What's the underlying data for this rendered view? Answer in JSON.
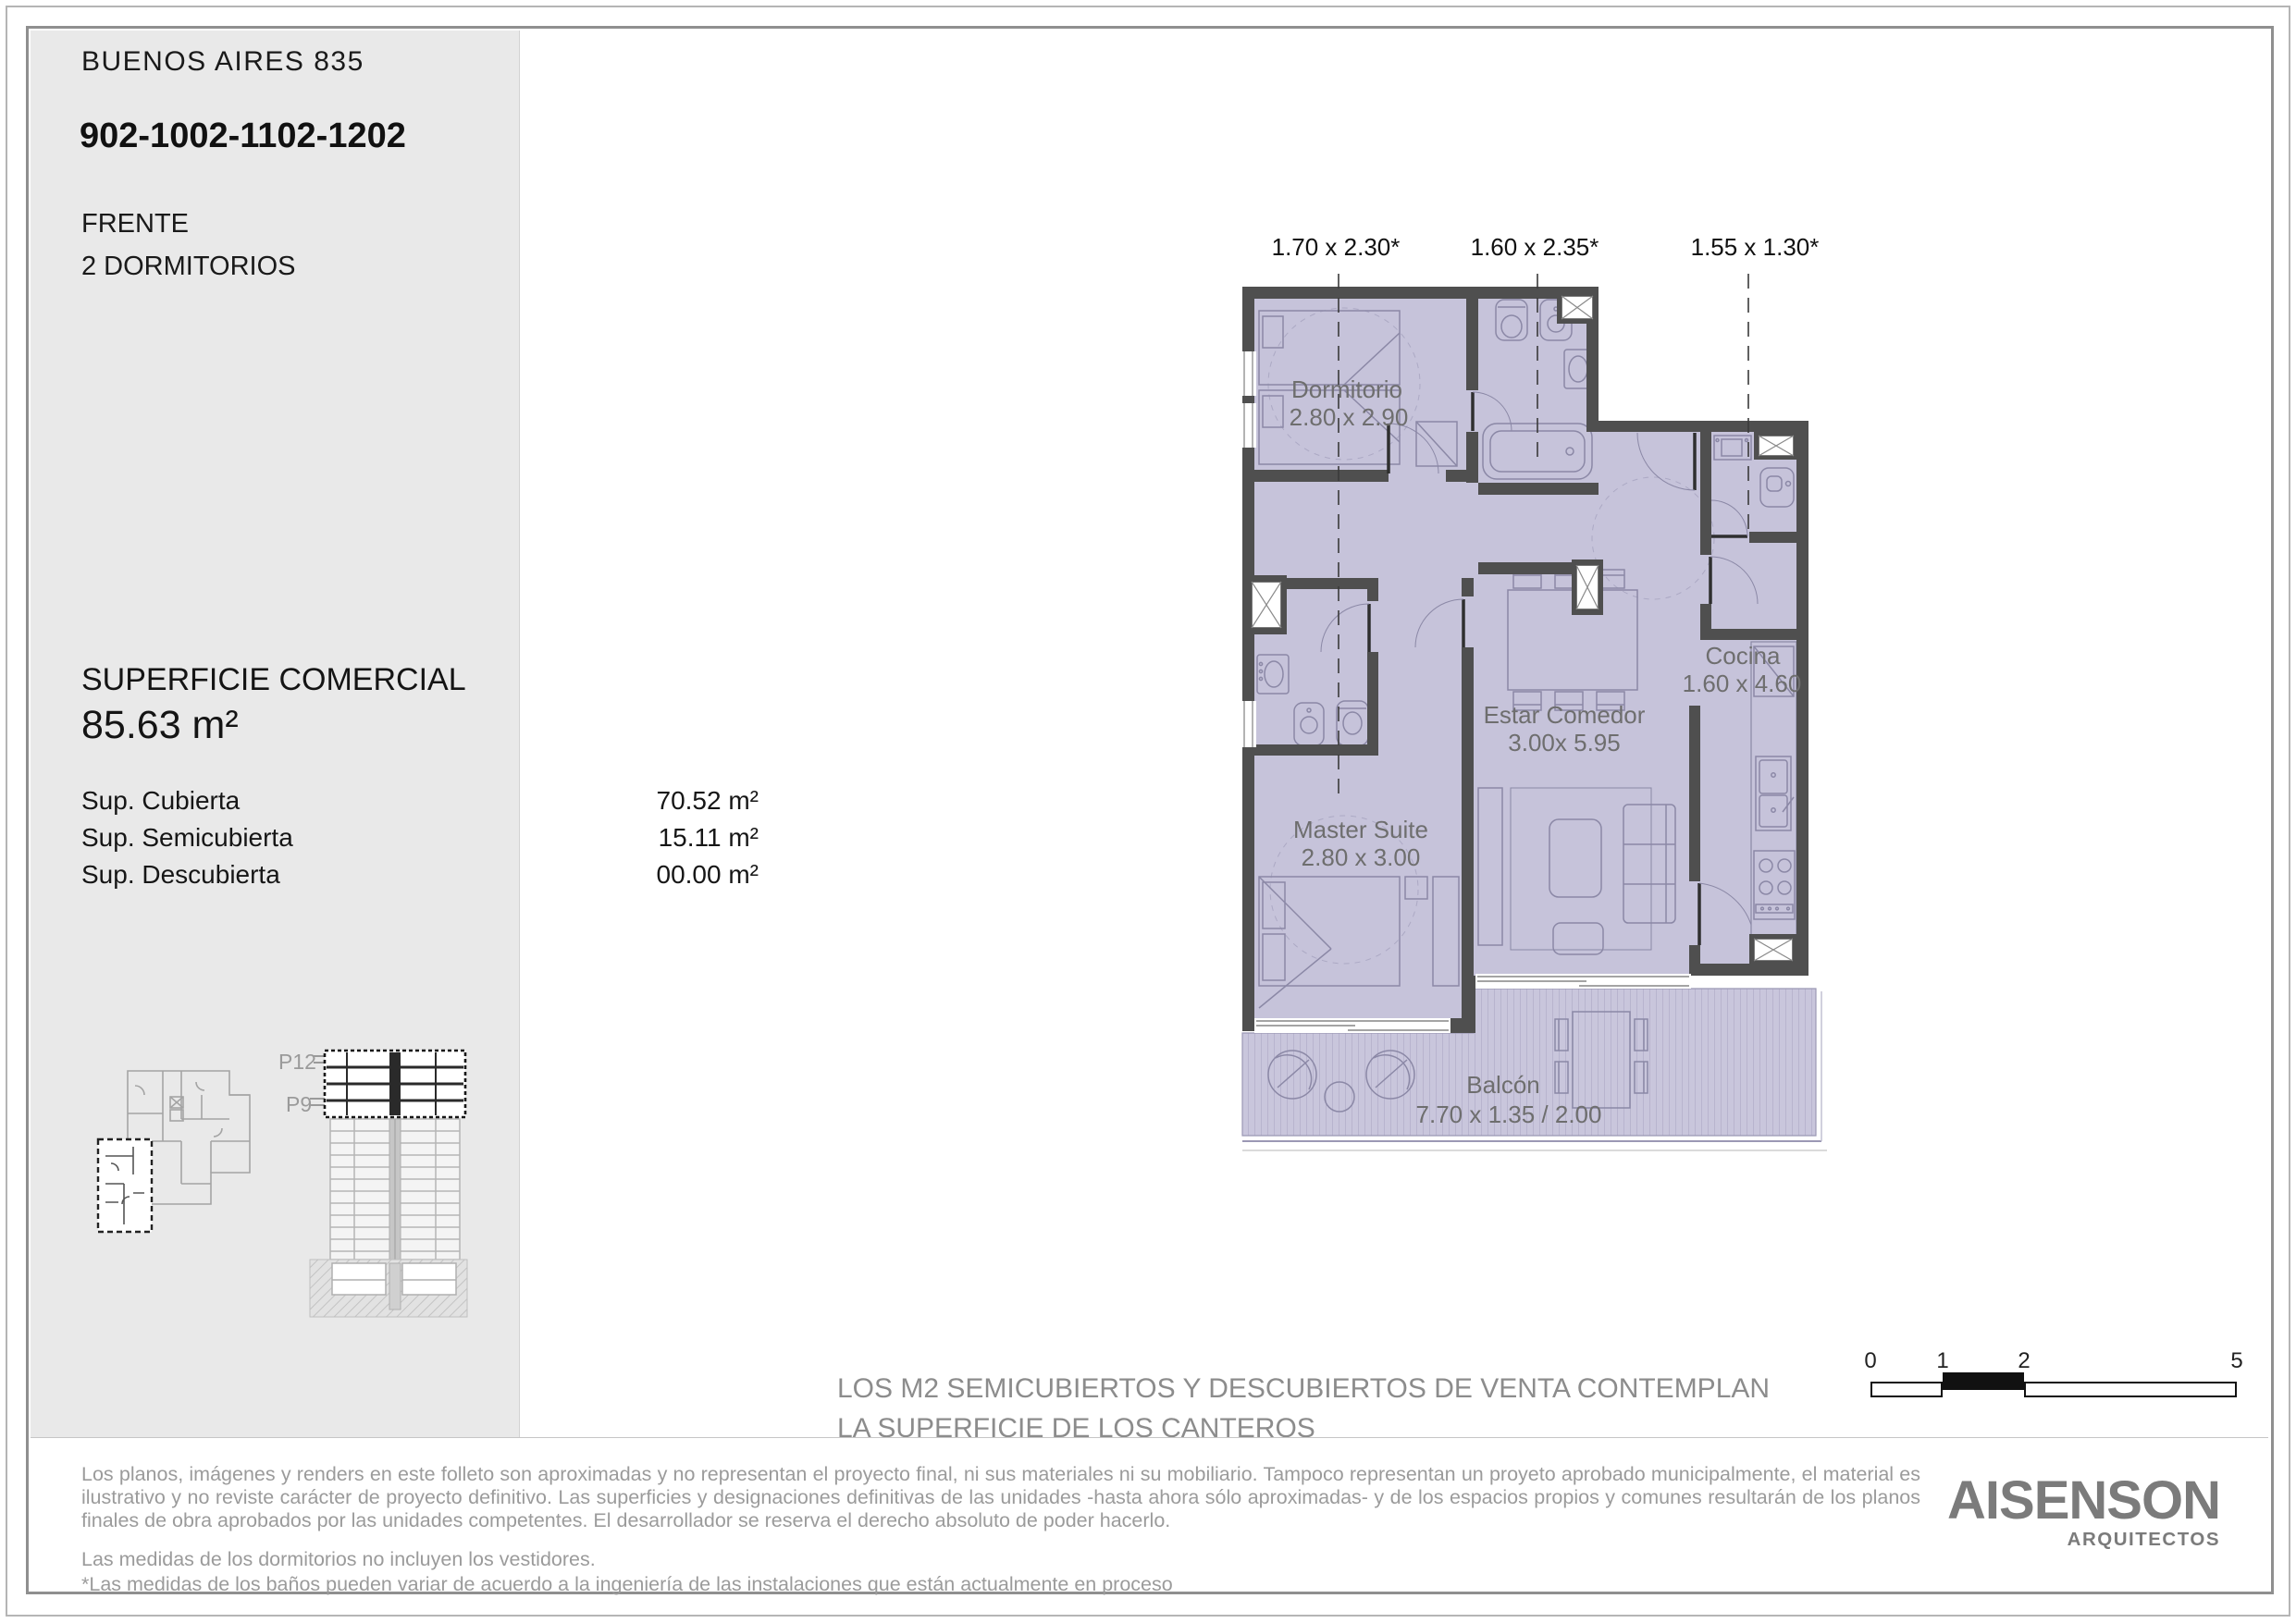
{
  "page": {
    "header": {
      "project": "BUENOS AIRES 835",
      "units": "902-1002-1102-1202",
      "orientation": "FRENTE",
      "typology": "2 DORMITORIOS"
    },
    "surface": {
      "title": "SUPERFICIE COMERCIAL",
      "total": "85.63 m²",
      "rows": [
        {
          "label": "Sup. Cubierta",
          "value": "70.52 m²"
        },
        {
          "label": "Sup. Semicubierta",
          "value": "15.11 m²"
        },
        {
          "label": "Sup. Descubierta",
          "value": "00.00 m²"
        }
      ]
    },
    "section_labels": {
      "p12": "P12",
      "p9": "P9"
    },
    "plan": {
      "dim_labels": [
        "1.70 x 2.30*",
        "1.60 x 2.35*",
        "1.55 x 1.30*"
      ],
      "rooms": {
        "dormitorio": {
          "name": "Dormitorio",
          "size": "2.80 x 2.90"
        },
        "estar": {
          "name": "Estar Comedor",
          "size": "3.00x 5.95"
        },
        "cocina": {
          "name": "Cocina",
          "size": "1.60 x 4.60"
        },
        "master": {
          "name": "Master Suite",
          "size": "2.80 x 3.00"
        },
        "balcon": {
          "name": "Balcón",
          "size": "7.70 x 1.35 / 2.00"
        }
      }
    },
    "scale_bar": {
      "t0": "0",
      "t1": "1",
      "t2": "2",
      "t5": "5"
    },
    "note": {
      "line1": "LOS M2 SEMICUBIERTOS Y DESCUBIERTOS DE VENTA CONTEMPLAN",
      "line2": "LA SUPERFICIE DE LOS CANTEROS"
    },
    "disclaimer": {
      "p1": "Los planos, imágenes y renders en este folleto son aproximadas y no representan el proyecto final, ni sus materiales ni su mobiliario. Tampoco representan un proyeto aprobado municipalmente, el material es ilustrativo y no reviste carácter de proyecto definitivo. Las superficies y designaciones definitivas de las unidades -hasta ahora sólo aproximadas- y de los espacios propios y comunes resultarán de los planos finales de obra aprobados por las unidades competentes. El desarrollador se reserva el derecho absoluto de poder hacerlo.",
      "p2": "Las medidas de los dormitorios no incluyen los vestidores.",
      "p3": "*Las medidas de los baños pueden variar de acuerdo a la ingeniería de las instalaciones que están actualmente en proceso"
    },
    "logo": {
      "name": "AISENSON",
      "sub": "ARQUITECTOS"
    },
    "colors": {
      "wall": "#4f4f4f",
      "room_fill": "#c6c3da",
      "balcony_fill": "#c9c6dc",
      "plan_text": "#6e6e6e",
      "gray_text": "#9b9b9b",
      "logo_gray": "#7b7b7b"
    }
  }
}
